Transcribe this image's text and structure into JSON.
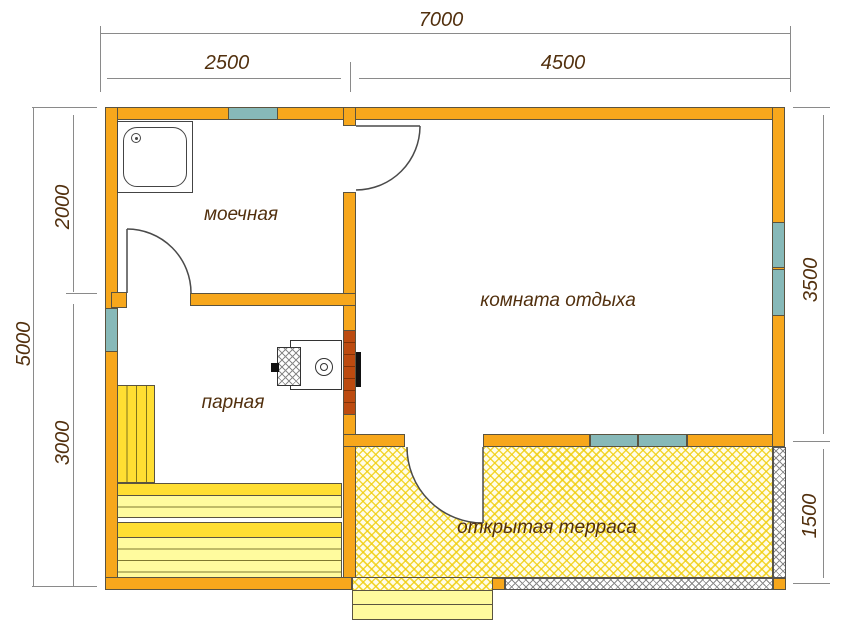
{
  "meta": {
    "type": "sauna floor plan"
  },
  "rooms": [
    {
      "id": "washroom",
      "label": "моечная"
    },
    {
      "id": "steam-room",
      "label": "парная"
    },
    {
      "id": "lounge",
      "label": "комната отдыха"
    },
    {
      "id": "terrace",
      "label": "открытая терраса"
    }
  ],
  "dims": {
    "total_width": "7000",
    "width_left": "2500",
    "width_right": "4500",
    "total_height": "5000",
    "height_upper": "2000",
    "height_lower": "3000",
    "right_upper": "3500",
    "right_lower": "1500"
  },
  "colors": {
    "wall": "#F7A71C",
    "win": "#87B9B8",
    "brick": "#BC4B10",
    "mortar": "rgba(80,30,0,0.55)",
    "outline": "#5a5340",
    "ink": "#52300e",
    "dim": "#8a8a8a",
    "bench": "#FFDE32",
    "benchpale": "#FFFB9E",
    "slat": "rgba(95,88,20,0.8)",
    "steps": "#FFFA9E",
    "hatchbg": "#FFFDE9",
    "hatch": "rgba(240,205,10,0.8)",
    "door": "#4a4a4a"
  }
}
